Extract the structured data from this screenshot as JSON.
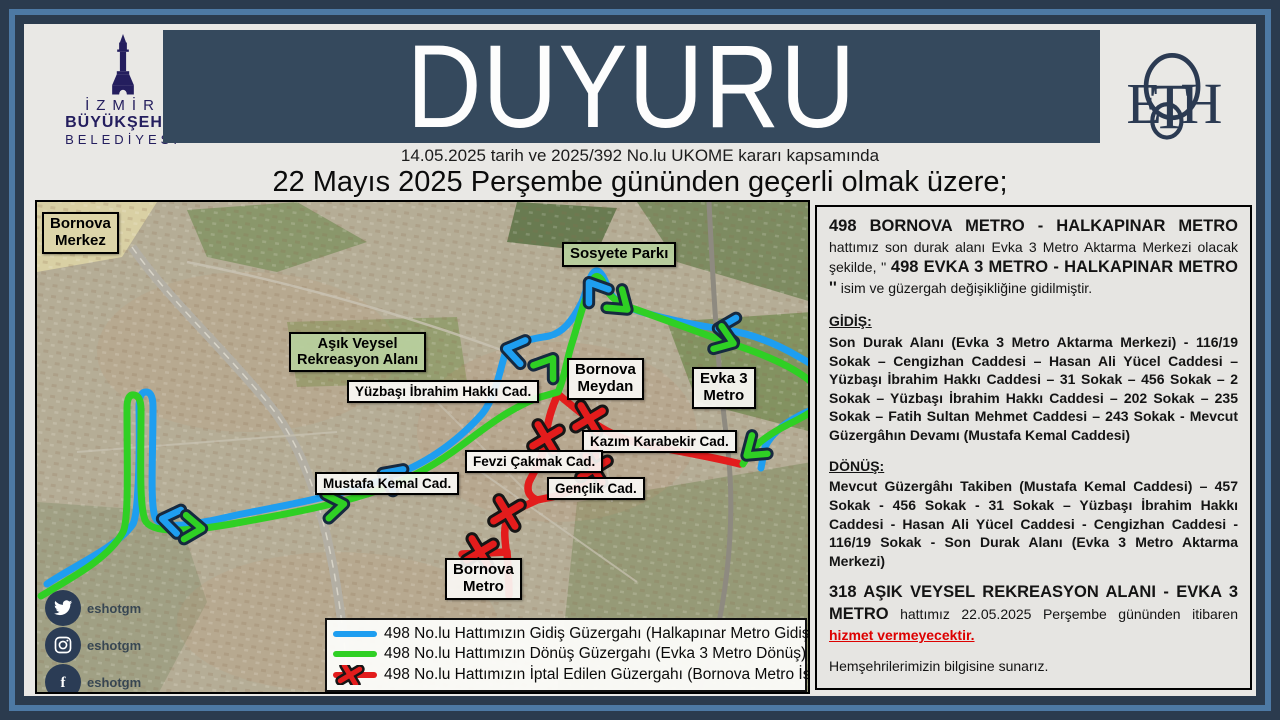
{
  "colors": {
    "route_gidis": "#1e9ef0",
    "route_donus": "#2fd024",
    "route_cancelled": "#e31c1c",
    "navy": "#241e5e",
    "eshot_navy": "#2b3a52",
    "header_bar": "#35495d",
    "warning_red": "#dd0000"
  },
  "header": {
    "title": "DUYURU",
    "date_line": "14.05.2025  tarih ve 2025/392  No.lu UKOME kararı kapsamında",
    "subtitle": "22 Mayıs 2025 Perşembe gününden geçerli olmak üzere;"
  },
  "logos": {
    "municipality": {
      "line1": "İZMİR",
      "line2": "BÜYÜKŞEHİR",
      "line3": "BELEDİYESİ"
    },
    "eshot": {
      "name": "ESHOT"
    }
  },
  "map": {
    "labels": {
      "bornova_merkez": "Bornova\nMerkez",
      "sosyete_parki": "Sosyete Parkı",
      "asik_veysel": "Aşık Veysel\nRekreasyon Alanı",
      "yuzbasi_ibrahim_hakki": "Yüzbaşı İbrahim Hakkı Cad.",
      "bornova_meydan": "Bornova\nMeydan",
      "evka3_metro": "Evka 3\nMetro",
      "kazim_karabekir": "Kazım Karabekir Cad.",
      "fevzi_cakmak": "Fevzi Çakmak Cad.",
      "genclik": "Gençlik Cad.",
      "mustafa_kemal": "Mustafa Kemal Cad.",
      "bornova_metro": "Bornova\nMetro"
    },
    "legend": {
      "gidis": "498 No.lu Hattımızın Gidiş Güzergahı (Halkapınar Metro Gidiş)",
      "donus": "498 No.lu Hattımızın Dönüş Güzergahı (Evka 3 Metro Dönüş)",
      "iptal": "498 No.lu Hattımızın İptal Edilen Güzergahı  (Bornova Metro İstikameti)"
    }
  },
  "panel": {
    "p1_bold1": "498 BORNOVA METRO - HALKAPINAR METRO",
    "p1_reg1": " hattımız son durak alanı Evka 3 Metro Aktarma Merkezi olacak şekilde, '' ",
    "p1_bold2": "498  EVKA 3 METRO - HALKAPINAR METRO ''",
    "p1_reg2": " isim ve güzergah değişikliğine gidilmiştir.",
    "gidis_heading": "GİDİŞ:",
    "gidis_body": "Son Durak Alanı (Evka 3 Metro Aktarma Merkezi) - 116/19 Sokak – Cengizhan Caddesi – Hasan Ali Yücel Caddesi – Yüzbaşı İbrahim Hakkı Caddesi – 31 Sokak – 456 Sokak – 2 Sokak – Yüzbaşı İbrahim Hakkı Caddesi – 202 Sokak – 235 Sokak – Fatih Sultan Mehmet Caddesi – 243 Sokak - Mevcut Güzergâhın Devamı (Mustafa Kemal Caddesi)",
    "donus_heading": "DÖNÜŞ:",
    "donus_body": "Mevcut Güzergâhı Takiben (Mustafa Kemal Caddesi) – 457 Sokak - 456 Sokak - 31 Sokak – Yüzbaşı İbrahim Hakkı Caddesi - Hasan Ali Yücel Caddesi - Cengizhan Caddesi - 116/19 Sokak - Son Durak Alanı (Evka 3 Metro Aktarma Merkezi)",
    "p318_bold": "318 AŞIK VEYSEL REKREASYON ALANI - EVKA 3 METRO",
    "p318_reg": " hattımız 22.05.2025 Perşembe gününden itibaren ",
    "p318_red": "hizmet vermeyecektir.",
    "closing": "Hemşehrilerimizin bilgisine sunarız."
  },
  "social": {
    "twitter": "eshotgm",
    "instagram": "eshotgm",
    "facebook": "eshotgm"
  }
}
